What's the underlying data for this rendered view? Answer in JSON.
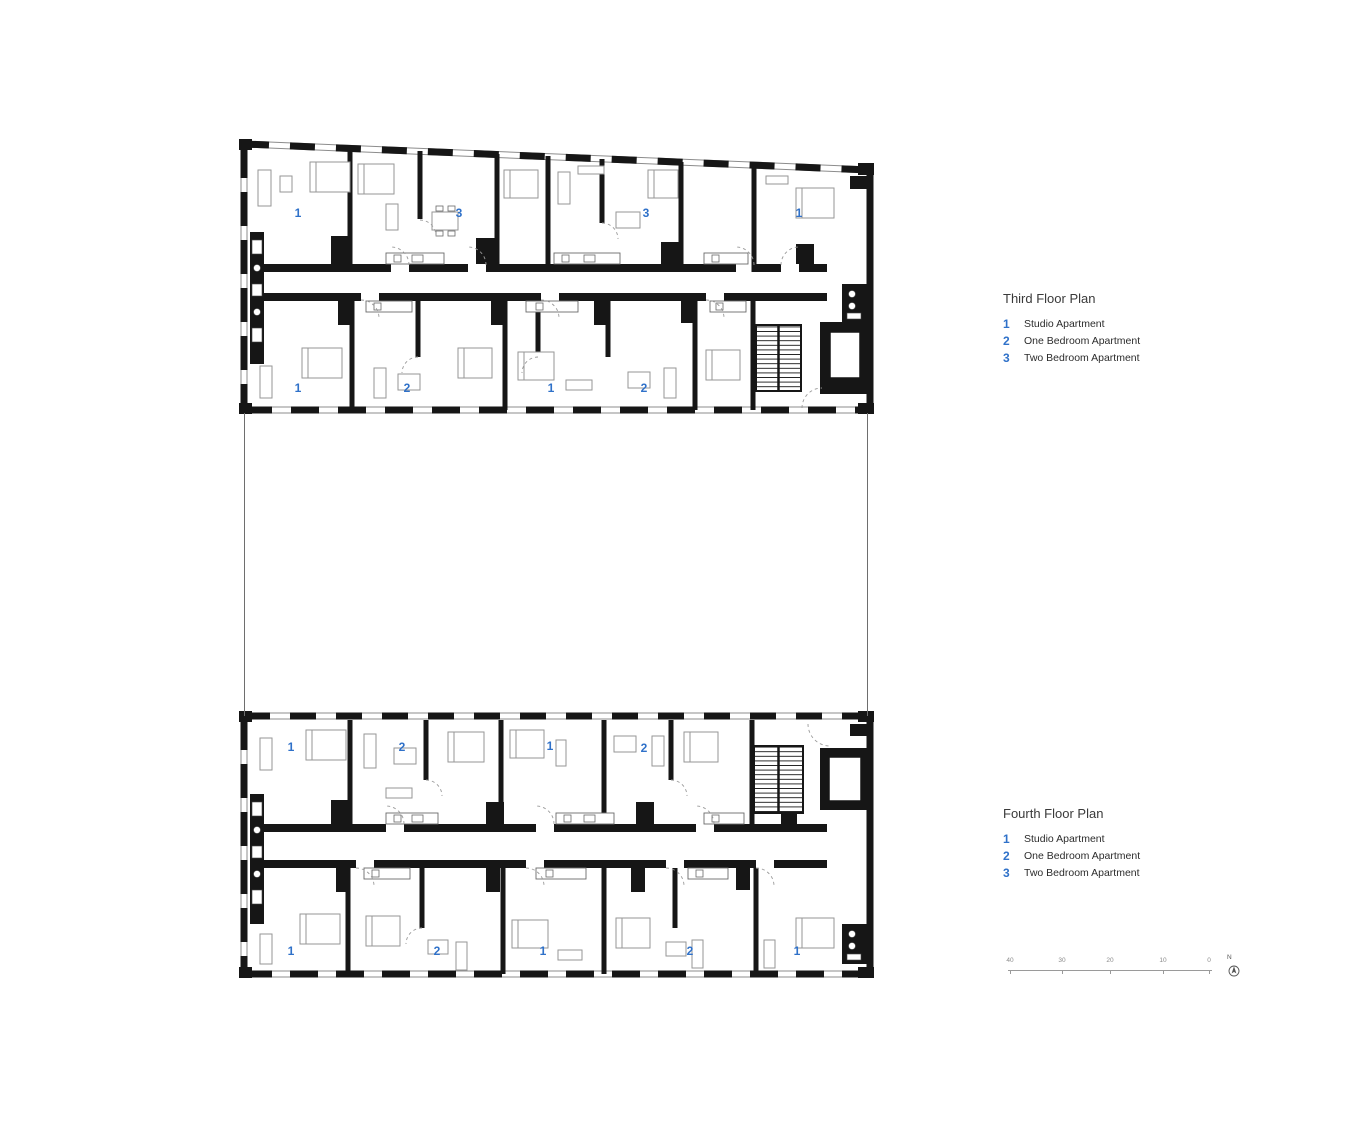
{
  "colors": {
    "accent_blue": "#2f71c9",
    "wall_black": "#161616",
    "furniture_gray": "#969696"
  },
  "plans": [
    {
      "name": "third-floor-plan",
      "legend_title": "Third Floor Plan",
      "legend_items": [
        {
          "number": "1",
          "label": "Studio Apartment"
        },
        {
          "number": "2",
          "label": "One Bedroom Apartment"
        },
        {
          "number": "3",
          "label": "Two Bedroom Apartment"
        }
      ],
      "unit_markers": [
        {
          "number": "1",
          "x": 298,
          "y": 213
        },
        {
          "number": "3",
          "x": 459,
          "y": 213
        },
        {
          "number": "3",
          "x": 646,
          "y": 213
        },
        {
          "number": "1",
          "x": 799,
          "y": 213
        },
        {
          "number": "1",
          "x": 298,
          "y": 388
        },
        {
          "number": "2",
          "x": 407,
          "y": 388
        },
        {
          "number": "1",
          "x": 551,
          "y": 388
        },
        {
          "number": "2",
          "x": 644,
          "y": 388
        }
      ]
    },
    {
      "name": "fourth-floor-plan",
      "legend_title": "Fourth Floor Plan",
      "legend_items": [
        {
          "number": "1",
          "label": "Studio Apartment"
        },
        {
          "number": "2",
          "label": "One Bedroom Apartment"
        },
        {
          "number": "3",
          "label": "Two Bedroom Apartment"
        }
      ],
      "unit_markers": [
        {
          "number": "1",
          "x": 291,
          "y": 747
        },
        {
          "number": "2",
          "x": 402,
          "y": 747
        },
        {
          "number": "1",
          "x": 550,
          "y": 746
        },
        {
          "number": "2",
          "x": 644,
          "y": 748
        },
        {
          "number": "1",
          "x": 291,
          "y": 951
        },
        {
          "number": "2",
          "x": 437,
          "y": 951
        },
        {
          "number": "1",
          "x": 543,
          "y": 951
        },
        {
          "number": "2",
          "x": 690,
          "y": 951
        },
        {
          "number": "1",
          "x": 797,
          "y": 951
        }
      ]
    }
  ],
  "scale_bar": {
    "tick_labels": [
      "40",
      "30",
      "20",
      "10",
      "0"
    ],
    "north_label": "N"
  }
}
